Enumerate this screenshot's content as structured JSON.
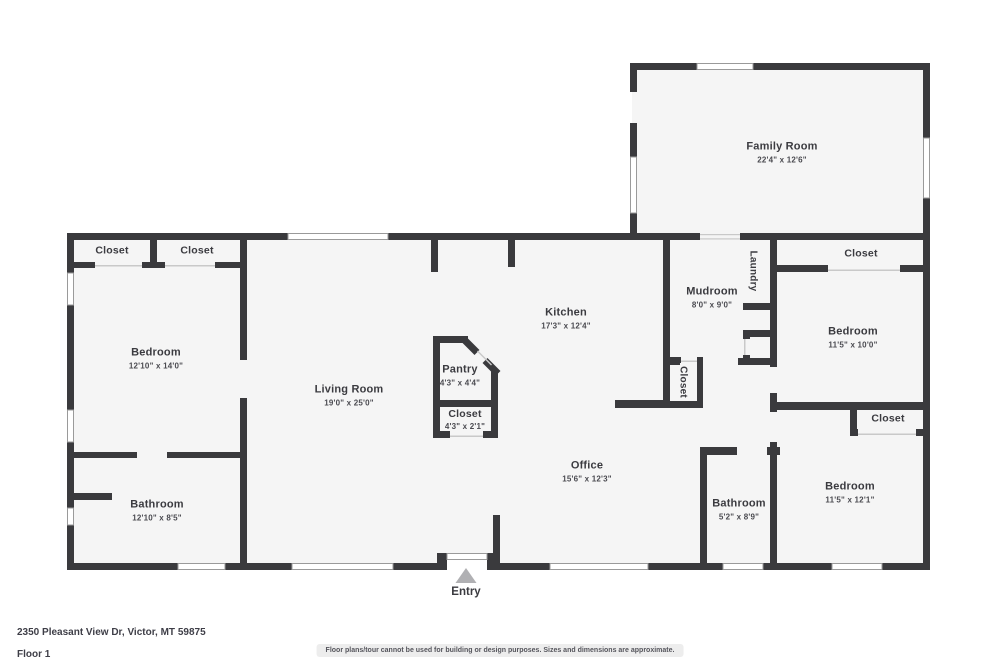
{
  "rooms": {
    "family_room": {
      "name": "Family Room",
      "dims": "22'4\" x 12'6\""
    },
    "closet_top_left_1": {
      "name": "Closet"
    },
    "closet_top_left_2": {
      "name": "Closet"
    },
    "bedroom_left": {
      "name": "Bedroom",
      "dims": "12'10\" x 14'0\""
    },
    "living_room": {
      "name": "Living Room",
      "dims": "19'0\" x 25'0\""
    },
    "kitchen": {
      "name": "Kitchen",
      "dims": "17'3\" x 12'4\""
    },
    "pantry": {
      "name": "Pantry",
      "dims": "4'3\" x 4'4\""
    },
    "closet_pantry": {
      "name": "Closet",
      "dims": "4'3\" x 2'1\""
    },
    "mudroom": {
      "name": "Mudroom",
      "dims": "8'0\" x 9'0\""
    },
    "laundry": {
      "name": "Laundry"
    },
    "closet_mudroom": {
      "name": "Closet"
    },
    "closet_top_right": {
      "name": "Closet"
    },
    "bedroom_top_right": {
      "name": "Bedroom",
      "dims": "11'5\" x 10'0\""
    },
    "closet_bottom_right": {
      "name": "Closet"
    },
    "bedroom_bottom_right": {
      "name": "Bedroom",
      "dims": "11'5\" x 12'1\""
    },
    "bathroom_right": {
      "name": "Bathroom",
      "dims": "5'2\" x 8'9\""
    },
    "office": {
      "name": "Office",
      "dims": "15'6\" x 12'3\""
    },
    "bathroom_left": {
      "name": "Bathroom",
      "dims": "12'10\" x 8'5\""
    }
  },
  "entry": {
    "label": "Entry"
  },
  "footer": {
    "address": "2350 Pleasant View Dr, Victor, MT 59875",
    "floor_label": "Floor 1",
    "disclaimer": "Floor plans/tour cannot be used for building or design purposes. Sizes and dimensions are approximate."
  },
  "colors": {
    "wall": "#3a3a3d",
    "floor_fill": "#f5f5f5",
    "window_line": "#9a9a9a",
    "entry_arrow": "#b0b0b3"
  }
}
